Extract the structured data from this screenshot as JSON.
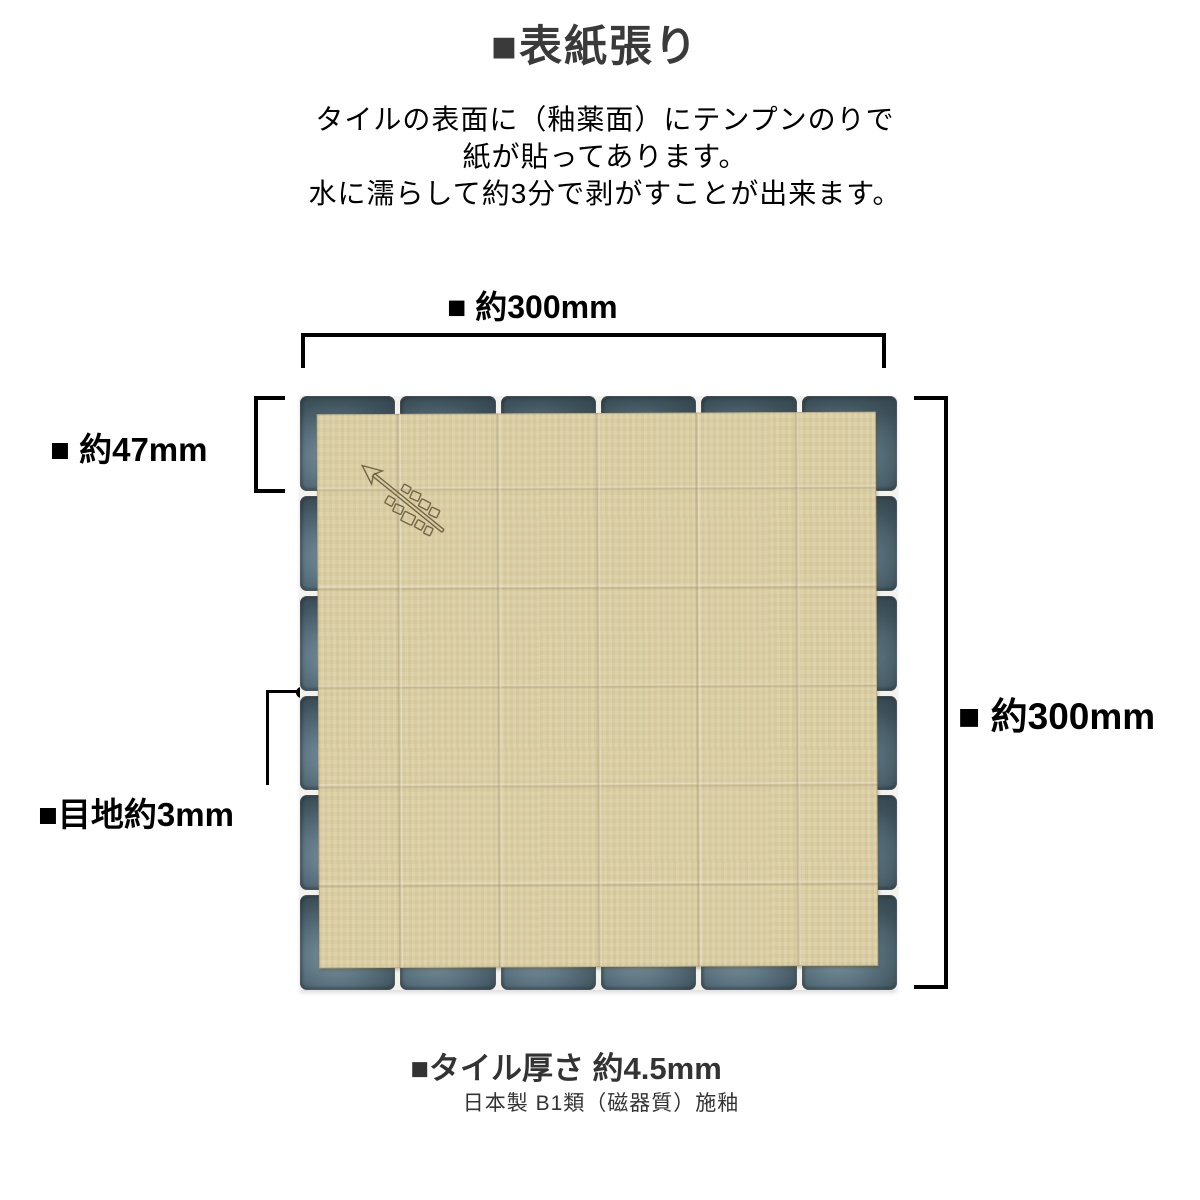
{
  "title": {
    "text": "■表紙張り"
  },
  "description": {
    "line1": "タイルの表面に（釉薬面）にテンプンのりで",
    "line2": "紙が貼ってあります。",
    "line3": "水に濡らして約3分で剥がすことが出来ます。"
  },
  "annotations": {
    "width_top": "■ 約300mm",
    "tile_size_left": "■ 約47mm",
    "height_right": "■ 約300mm",
    "joint": "■目地約3mm",
    "thickness": "■タイル厚さ 約4.5mm",
    "origin": "日本製 B1類（磁器質）施釉"
  },
  "diagram": {
    "grid_rows": 6,
    "grid_cols": 6,
    "icons": {
      "arrow_stamp": "direction-arrow-stamp"
    },
    "colors": {
      "title_text": "#3a3a3a",
      "footer_text": "#333333",
      "line": "#000000",
      "tile": "#3e525c",
      "tile_highlight": "#7e959f",
      "tile_dark": "#2b3a43",
      "grout": "#f3f2ec",
      "paper": "#dccfa4",
      "stamp": "#6b5c40"
    }
  }
}
